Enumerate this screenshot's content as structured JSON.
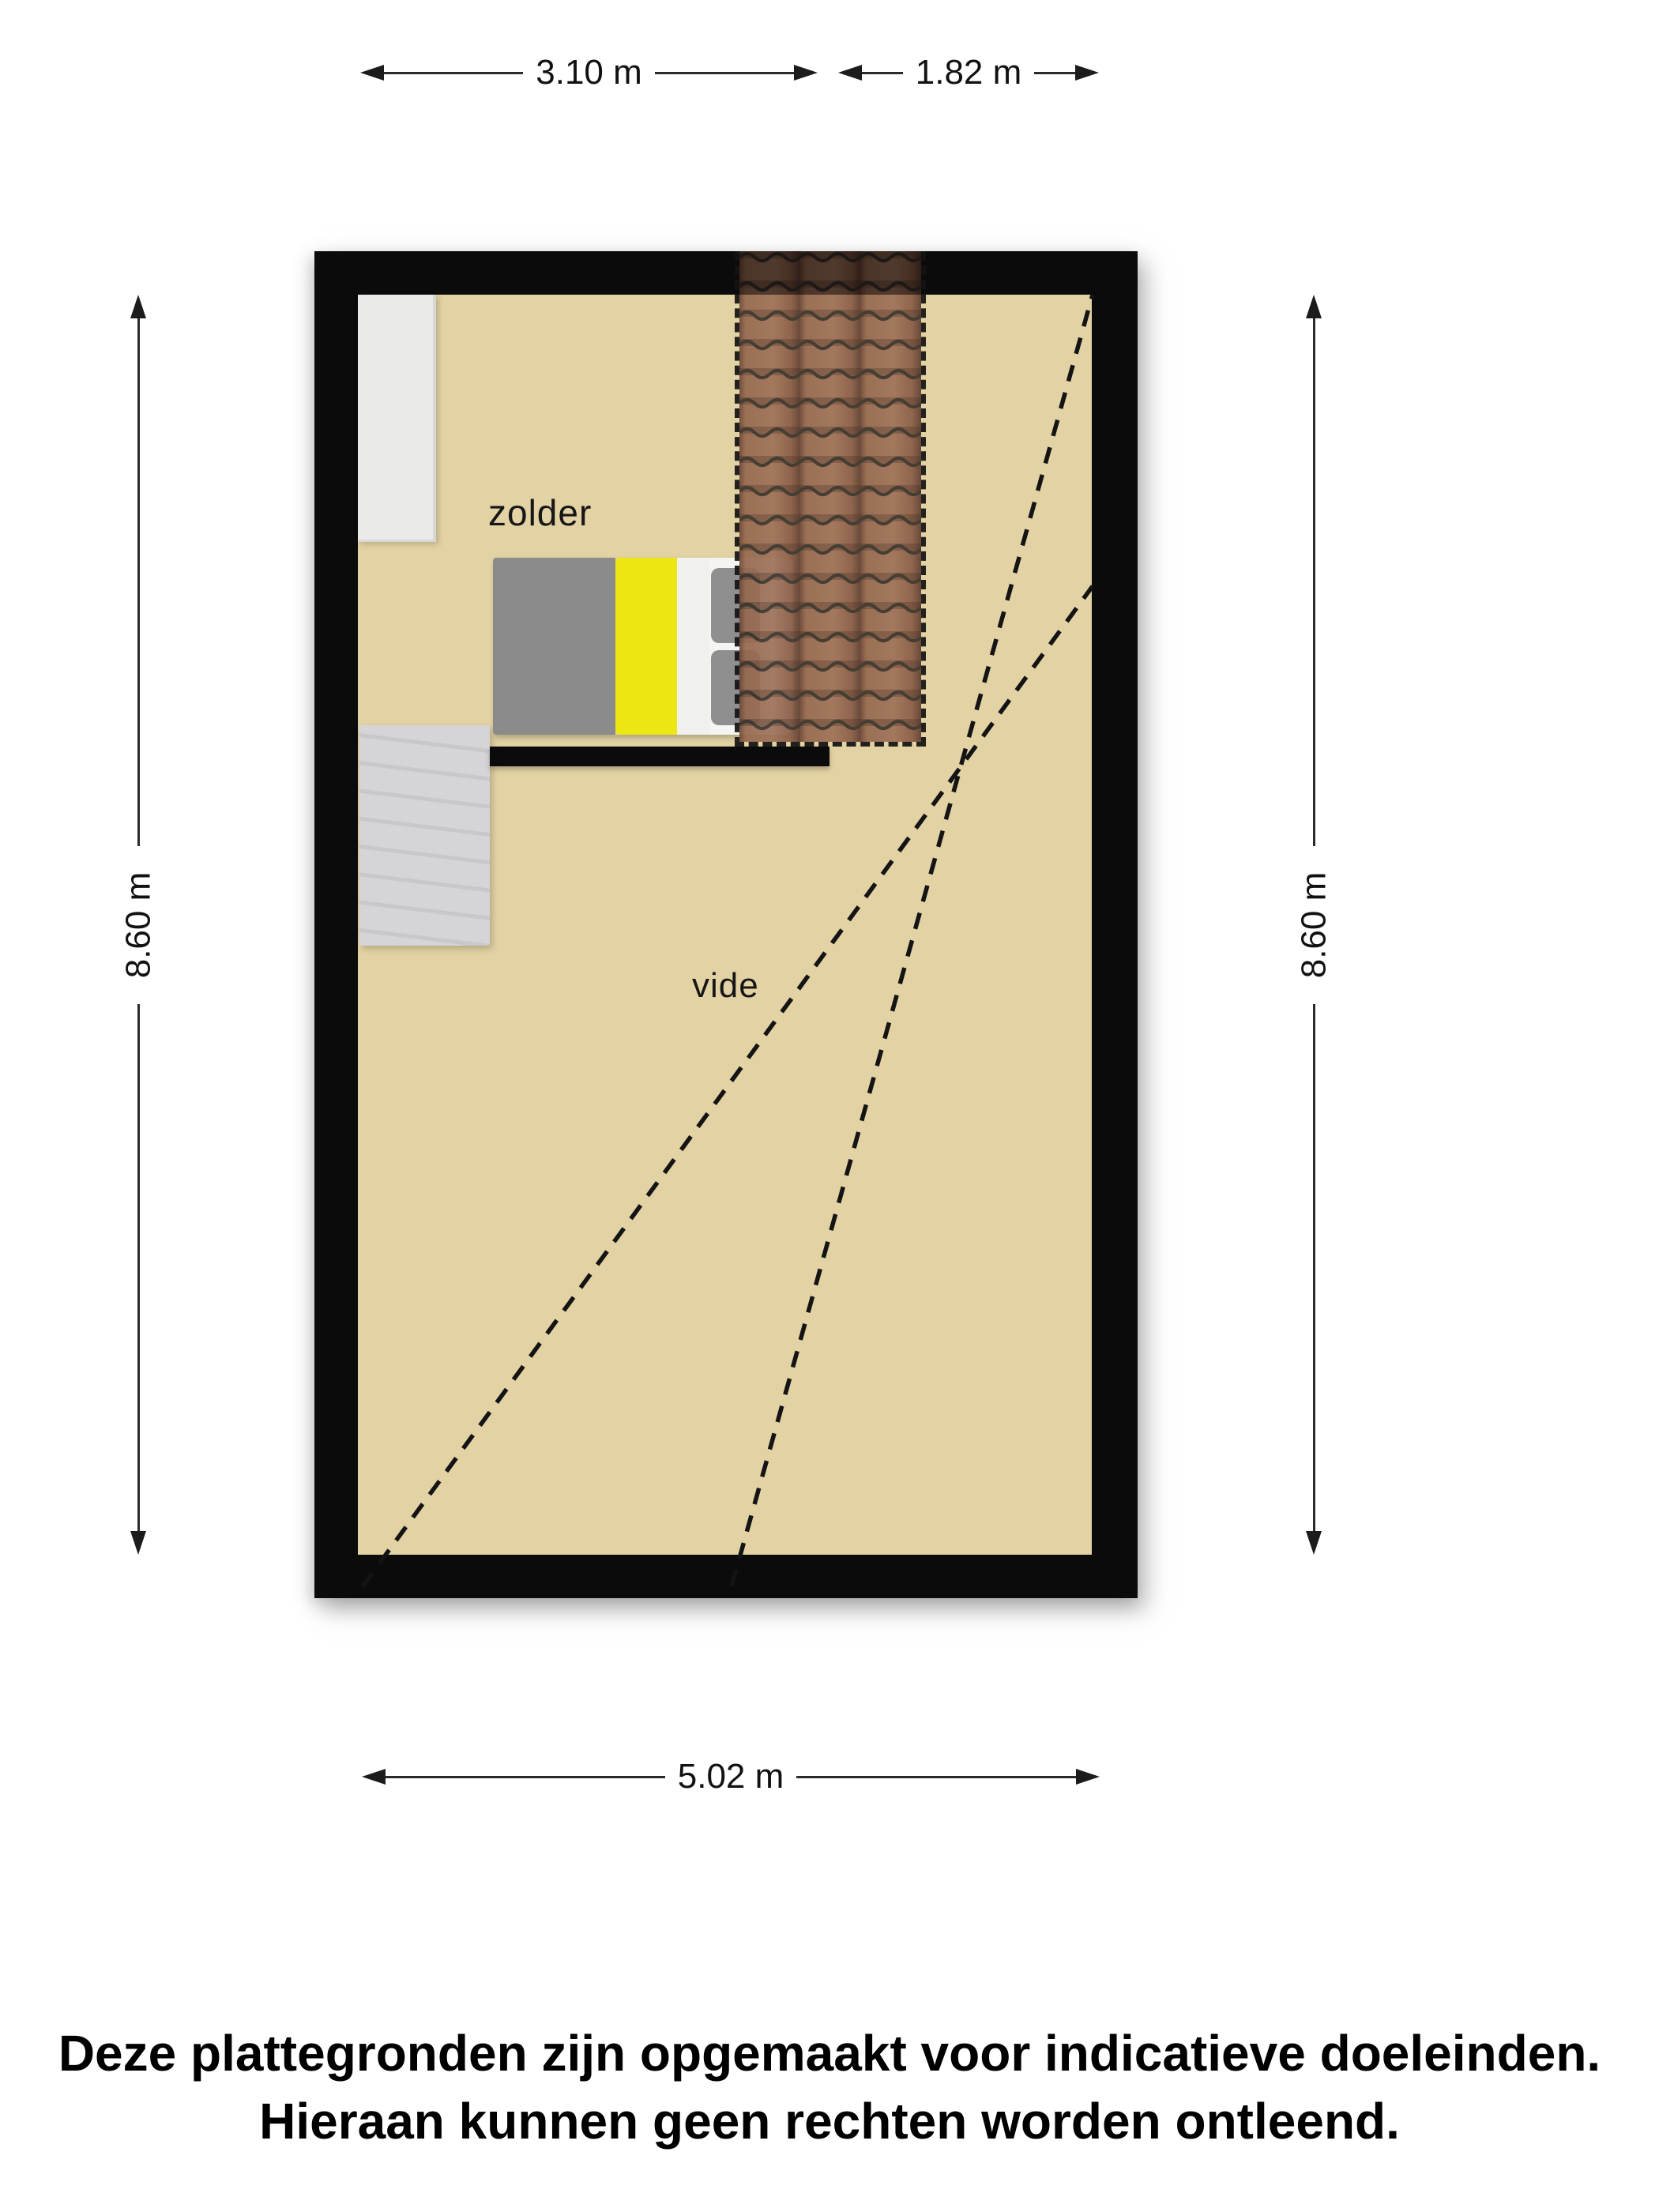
{
  "plan": {
    "room_label": "zolder",
    "void_label": "vide"
  },
  "dimensions": {
    "top_room_width": "3.10 m",
    "top_void_width": "1.82 m",
    "left_height": "8.60 m",
    "right_height": "8.60 m",
    "bottom_width": "5.02 m"
  },
  "disclaimer": {
    "line1": "Deze plattegronden zijn opgemaakt voor indicatieve doeleinden.",
    "line2": "Hieraan kunnen geen rechten worden ontleend."
  },
  "colors": {
    "floor": "#e3d2a3",
    "wall": "#0b0b0b",
    "roof_tile": "#94684f",
    "roof_seam": "#3a322a",
    "bed_blanket_gray": "#8b8b8b",
    "bed_accent_yellow": "#ece613",
    "bed_linen_white": "#f4f4f2",
    "stairs_gray": "#d5d5d7",
    "wardrobe_white": "#eaeae8",
    "dimension_text": "#111111"
  }
}
